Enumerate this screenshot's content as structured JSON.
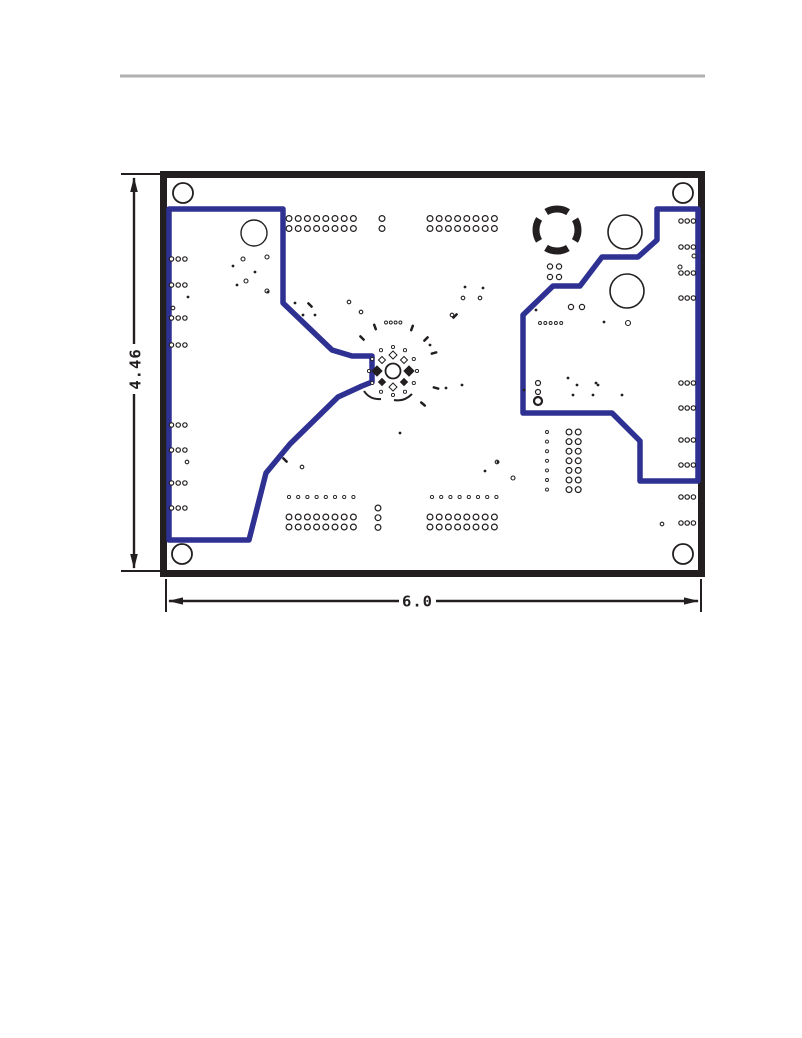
{
  "header": {
    "rule_color": "#b0b0b0"
  },
  "figure": {
    "description": "PCB bottom layer assembly drawing with board dimensions",
    "labels": {
      "width": "6.0",
      "height": "4.46"
    },
    "colors": {
      "ink": "#231f20",
      "copper": "#2e3192",
      "board_fill": "#ffffff"
    },
    "board": {
      "x": 163.5,
      "y": 174.5,
      "w": 538,
      "h": 399,
      "stroke_width": 7
    },
    "paths": {
      "left_pour": "M 169,540 L 169,209 L 283,209 L 283,303 L 332,350 L 352,356 L 372,356 L 372,382 L 362,386 L 338,397 L 290,444 L 266,473 L 249,540 Z",
      "right_pour": "M 657,209 L 698,209 L 698,481 L 640,481 L 640,441 L 612,413 L 523,413 L 523,315 L 553,286 L 580,286 L 602,257 L 638,257 L 657,240 Z",
      "dim_v": "M 134,178 L 134,344 M 134,394 L 134,568",
      "dim_h": "M 169,601 L 399,601 M 436,601 L 698,601",
      "ext_lines": "M 121,174 L 166,174 M 121,571 L 163,571 M 166,579 L 166,612 M 701,579 L 701,612",
      "arrows": "M 134,177 L 130.2,192 L 137.8,192 Z M 134,569 L 130.2,554 L 137.8,554 Z M 168,601 L 183,597.4 L 183,604.6 Z M 699,601 L 684,597.4 L 684,604.6 Z",
      "ring_arc1": "M 364,391 Q 370,400 381,399",
      "ring_arc2": "M 394,400 Q 404,402 412,394"
    },
    "mounting_hole_r": 10,
    "mounting_holes": [
      [
        183,
        193
      ],
      [
        683,
        193
      ],
      [
        182,
        554
      ],
      [
        683,
        554
      ]
    ],
    "component_circles": [
      [
        254,
        233,
        13,
        1.4
      ],
      [
        625,
        232,
        17,
        1.6
      ],
      [
        627,
        291,
        17,
        1.6
      ],
      [
        538,
        401,
        4,
        2.2
      ]
    ],
    "thermal_pad": {
      "cx": 557,
      "cy": 230,
      "r": 21,
      "stroke_width": 7,
      "dash": "23 10",
      "offset": 11.5
    },
    "center_footprint": {
      "cx": 393,
      "cy": 371,
      "hole_r": 7.5,
      "pad_ring_r": 24,
      "pad_count": 12,
      "pad_r": 1.6,
      "diamonds": [
        [
          409,
          371,
          5,
          1
        ],
        [
          377,
          371,
          5,
          1
        ],
        [
          393,
          355,
          4,
          0
        ],
        [
          393,
          387,
          4,
          0
        ],
        [
          404,
          360,
          3.5,
          0
        ],
        [
          382,
          360,
          3.5,
          0
        ],
        [
          404,
          382,
          3.5,
          1
        ],
        [
          382,
          382,
          3.5,
          1
        ]
      ]
    },
    "via_grids": [
      {
        "x": 289,
        "y": 218.5,
        "dx": 9.2,
        "dy": 10,
        "cols": 8,
        "rows": 2,
        "cr": 2.9
      },
      {
        "x": 430,
        "y": 218.5,
        "dx": 9.2,
        "dy": 10,
        "cols": 8,
        "rows": 2,
        "cr": 2.9
      },
      {
        "x": 382,
        "y": 218.5,
        "dy": 10,
        "cols": 1,
        "rows": 2,
        "cr": 2.9
      },
      {
        "x": 289,
        "y": 517,
        "dx": 9.2,
        "dy": 10,
        "cols": 8,
        "rows": 2,
        "cr": 2.9
      },
      {
        "x": 430,
        "y": 517,
        "dx": 9.2,
        "dy": 10,
        "cols": 8,
        "rows": 2,
        "cr": 2.9
      },
      {
        "x": 289,
        "y": 497,
        "dx": 9.2,
        "cols": 8,
        "rows": 1,
        "cr": 1.6
      },
      {
        "x": 432,
        "y": 497,
        "dx": 9.2,
        "cols": 8,
        "rows": 1,
        "cr": 1.6
      },
      {
        "x": 378,
        "y": 508,
        "dy": 9.7,
        "cols": 1,
        "rows": 3,
        "cr": 2.9
      },
      {
        "x": 569,
        "y": 432,
        "dx": 9.2,
        "dy": 9.6,
        "cols": 2,
        "rows": 7,
        "cr": 2.9
      },
      {
        "x": 547,
        "y": 432,
        "dy": 9.6,
        "cols": 1,
        "rows": 7,
        "cr": 1.5
      },
      {
        "x": 171.5,
        "dx": 6.7,
        "cols": 3,
        "cr": 2.2,
        "ys": [
          259,
          285,
          318,
          345,
          425,
          450,
          483,
          508
        ]
      },
      {
        "x": 681,
        "dx": 6.2,
        "cols": 3,
        "cr": 2.2,
        "ys": [
          221,
          247,
          273,
          298,
          383,
          408,
          440,
          465,
          497,
          523
        ]
      },
      {
        "x": 550,
        "y": 266.5,
        "dx": 9,
        "dy": 10.5,
        "cols": 2,
        "rows": 2,
        "cr": 2.6
      },
      {
        "x": 571,
        "y": 307,
        "dx": 11,
        "cols": 2,
        "rows": 1,
        "cr": 2.6
      },
      {
        "x": 540,
        "y": 323,
        "dx": 5.3,
        "cols": 5,
        "rows": 1,
        "cr": 1.5
      },
      {
        "x": 538,
        "y": 383,
        "dy": 9,
        "cols": 1,
        "rows": 2,
        "cr": 2.5
      },
      {
        "x": 386,
        "y": 322.5,
        "dx": 4.8,
        "cols": 4,
        "rows": 1,
        "cr": 1.5
      }
    ],
    "via_singles": [
      [
        628,
        323,
        2.5
      ],
      [
        173,
        308,
        1.8
      ],
      [
        243,
        259,
        2
      ],
      [
        246,
        281,
        2
      ],
      [
        267,
        257,
        2
      ],
      [
        267,
        291,
        2
      ],
      [
        680,
        267,
        2
      ],
      [
        694,
        256,
        2
      ],
      [
        662,
        524,
        1.8
      ],
      [
        513,
        478,
        2
      ],
      [
        463,
        298,
        1.8
      ],
      [
        480,
        298,
        1.8
      ],
      [
        497,
        462,
        1.8
      ],
      [
        452,
        315,
        1.8
      ],
      [
        187,
        462,
        1.8
      ],
      [
        302,
        467,
        1.8
      ],
      [
        349,
        302,
        1.8
      ],
      [
        361,
        312,
        1.8
      ]
    ],
    "dots": [
      [
        233,
        266
      ],
      [
        255,
        272
      ],
      [
        188,
        297
      ],
      [
        237,
        285
      ],
      [
        268,
        292
      ],
      [
        295,
        303
      ],
      [
        303,
        315
      ],
      [
        315,
        315
      ],
      [
        465,
        287
      ],
      [
        483,
        288
      ],
      [
        430,
        345
      ],
      [
        577,
        385
      ],
      [
        598,
        385
      ],
      [
        573,
        395
      ],
      [
        593,
        395
      ],
      [
        622,
        395
      ],
      [
        498,
        462
      ],
      [
        485,
        471
      ],
      [
        400,
        433
      ],
      [
        524,
        390
      ],
      [
        568,
        378
      ],
      [
        596,
        383
      ],
      [
        446,
        388
      ],
      [
        462,
        385
      ],
      [
        536,
        310
      ],
      [
        604,
        322
      ]
    ],
    "dashes": [
      [
        362,
        338,
        45
      ],
      [
        375,
        327,
        70
      ],
      [
        412,
        328,
        -70
      ],
      [
        426,
        339,
        -45
      ],
      [
        434,
        353,
        -15
      ],
      [
        436,
        388,
        15
      ],
      [
        423,
        404,
        40
      ],
      [
        310,
        305,
        45
      ],
      [
        455,
        316,
        -45
      ],
      [
        285,
        460,
        45
      ]
    ]
  }
}
